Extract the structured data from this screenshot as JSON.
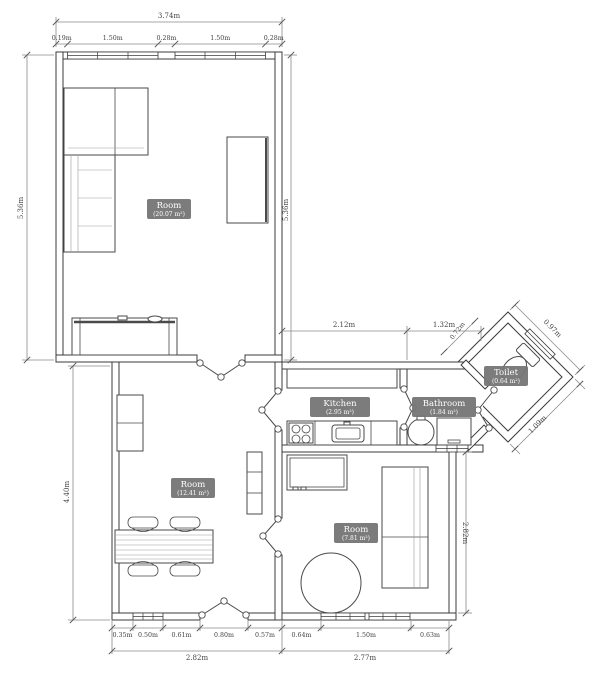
{
  "rooms": [
    {
      "name": "Room",
      "area": "(20.07 m²)"
    },
    {
      "name": "Room",
      "area": "(12.41 m²)"
    },
    {
      "name": "Room",
      "area": "(7.81 m²)"
    },
    {
      "name": "Kitchen",
      "area": "(2.95 m²)"
    },
    {
      "name": "Bathroom",
      "area": "(1.84 m²)"
    },
    {
      "name": "Toilet",
      "area": "(0.64 m²)"
    }
  ],
  "dims": {
    "top_total": "3.74m",
    "top_segments": [
      "0.19m",
      "1.50m",
      "0.28m",
      "1.50m",
      "0.28m"
    ],
    "left_upper": "5.36m",
    "right_upper": "5.36m",
    "left_lower": "4.40m",
    "mid_left": "2.12m",
    "mid_right": "1.32m",
    "diag_upper_left": "0.72m",
    "diag_upper_right": "0.97m",
    "diag_lower_right": "1.09m",
    "right_lower": "2.82m",
    "bottom_left_segments": [
      "0.35m",
      "0.50m",
      "0.61m",
      "0.80m",
      "0.57m"
    ],
    "bottom_left_total": "2.82m",
    "bottom_right_segments": [
      "0.64m",
      "1.50m",
      "0.63m"
    ],
    "bottom_right_total": "2.77m"
  },
  "colors": {
    "wall": "#3b3b3b",
    "furniture": "#4a4a4a",
    "dimension": "#8a8a8a",
    "dim_text": "#444444",
    "label_bg": "#757575",
    "label_text": "#ffffff",
    "background": "#ffffff"
  }
}
